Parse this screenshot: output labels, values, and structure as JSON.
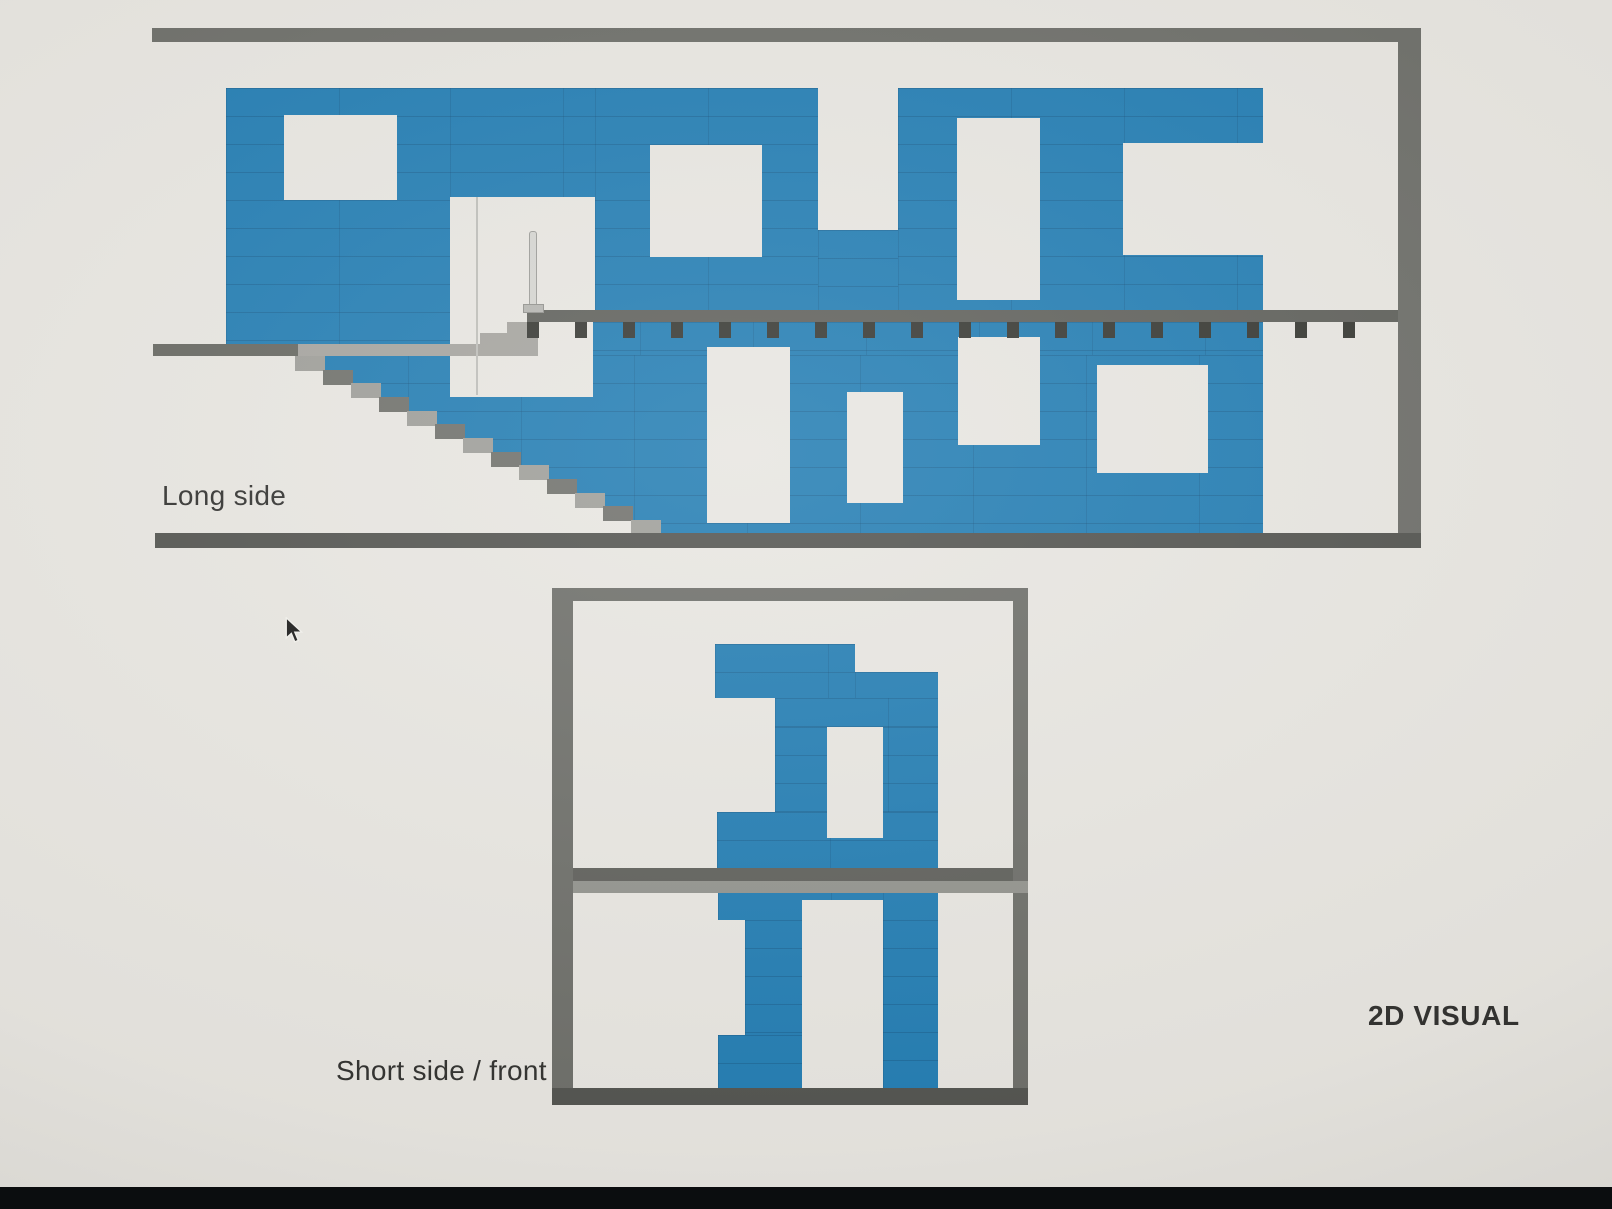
{
  "screen": {
    "description": "Photographed monitor showing a 2D block-construction visual with two elevation drawings"
  },
  "labels": {
    "long_side": "Long side",
    "short_side_front": "Short side / front",
    "visual_2d": "2D VISUAL"
  },
  "elevations": [
    {
      "id": "long-side",
      "label": "Long side",
      "storeys": 2,
      "window_openings": 8,
      "has_staircase": true,
      "has_floor_joists": true
    },
    {
      "id": "short-side-front",
      "label": "Short side / front",
      "storeys": 2,
      "window_openings": 2
    }
  ],
  "cursor": {
    "type": "arrow-pointer"
  },
  "colors": {
    "paper": "#e7e5e0",
    "blue": "#1e7ab1",
    "bluejoint": "#14608f",
    "frame": "#6a6b66",
    "framedark": "#4f504c",
    "slab": "#5c5d58",
    "tick": "#33342f",
    "landlight": "#a3a29d",
    "landdark": "#64655f",
    "steplight": "#9c9c97",
    "stepdark": "#6d6e69",
    "floorlight": "#90918b",
    "rail": "#d4d4d0",
    "doorline": "#bdbdb8",
    "text": "#2d2d2b",
    "bezel": "#0b0d0f"
  }
}
